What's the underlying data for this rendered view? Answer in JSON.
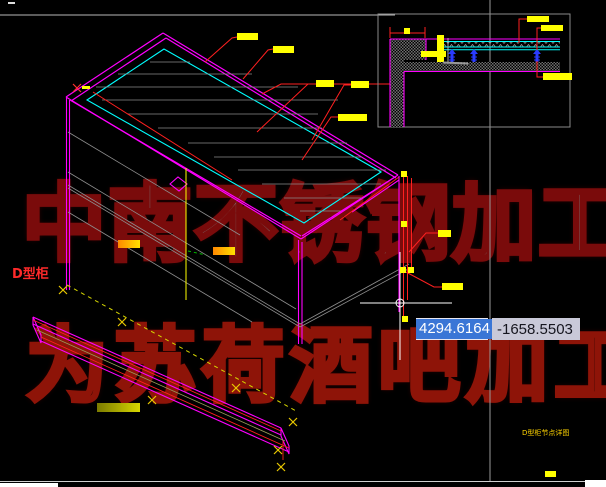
{
  "canvas": {
    "width": 606,
    "height": 487,
    "background": "#000000"
  },
  "watermark": {
    "line1": "中南不锈钢加工厂",
    "line2": "为苏荷酒吧加工生产",
    "line1_fill": "#7d7d7d",
    "line1_outline": "#7a0b0b",
    "line2_fill": "#140000",
    "line2_outline": "#8e1408"
  },
  "labels": {
    "cabinet_type": "D型柜",
    "detail_caption": "D型柜节点详图"
  },
  "dynamic_input": {
    "x_value": "4294.6164",
    "y_value": "-1658.5503",
    "selection_color": "#3a76d6",
    "field_bg": "#c9c9d8"
  },
  "palette": {
    "outline_magenta": "#ff00ff",
    "edge_cyan": "#00ffff",
    "leader_red": "#ff2020",
    "dimension_yellow": "#ffff00",
    "aux_gray": "#8a8a8a",
    "screw_blue": "#2a3bff",
    "hatch_gray": "#707070",
    "blip_yellow": "#e8c800"
  }
}
